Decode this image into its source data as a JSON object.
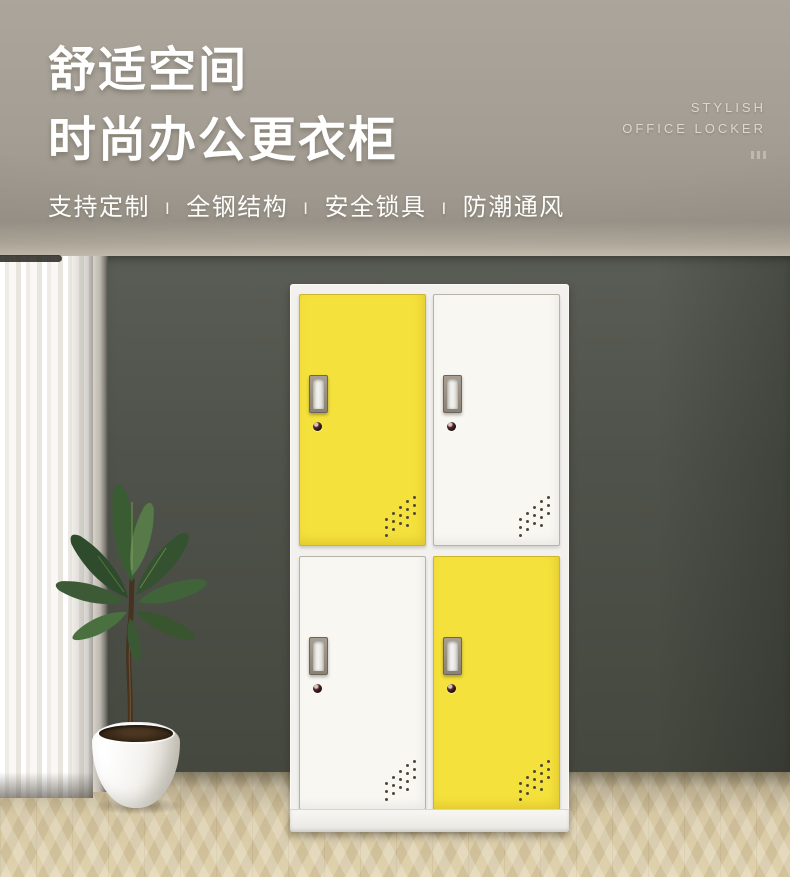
{
  "hero": {
    "title_line1": "舒适空间",
    "title_line2": "时尚办公更衣柜",
    "features": [
      "支持定制",
      "全钢结构",
      "安全锁具",
      "防潮通风"
    ],
    "feature_separator": "I",
    "brand_line1": "STYLISH",
    "brand_line2": "OFFICE LOCKER"
  },
  "locker": {
    "doors": [
      {
        "position": "top-left",
        "color_name": "yellow",
        "color": "#f5e13c"
      },
      {
        "position": "top-right",
        "color_name": "white",
        "color": "#f8f7f2"
      },
      {
        "position": "bottom-left",
        "color_name": "white",
        "color": "#f8f7f2"
      },
      {
        "position": "bottom-right",
        "color_name": "yellow",
        "color": "#f5e13c"
      }
    ]
  },
  "palette": {
    "header_background": "#a49e94",
    "wall": "#4d5048",
    "floor_wood": "#d6c7a2",
    "accent_yellow": "#f5e13c",
    "curtain_white": "#f7f5f1"
  }
}
